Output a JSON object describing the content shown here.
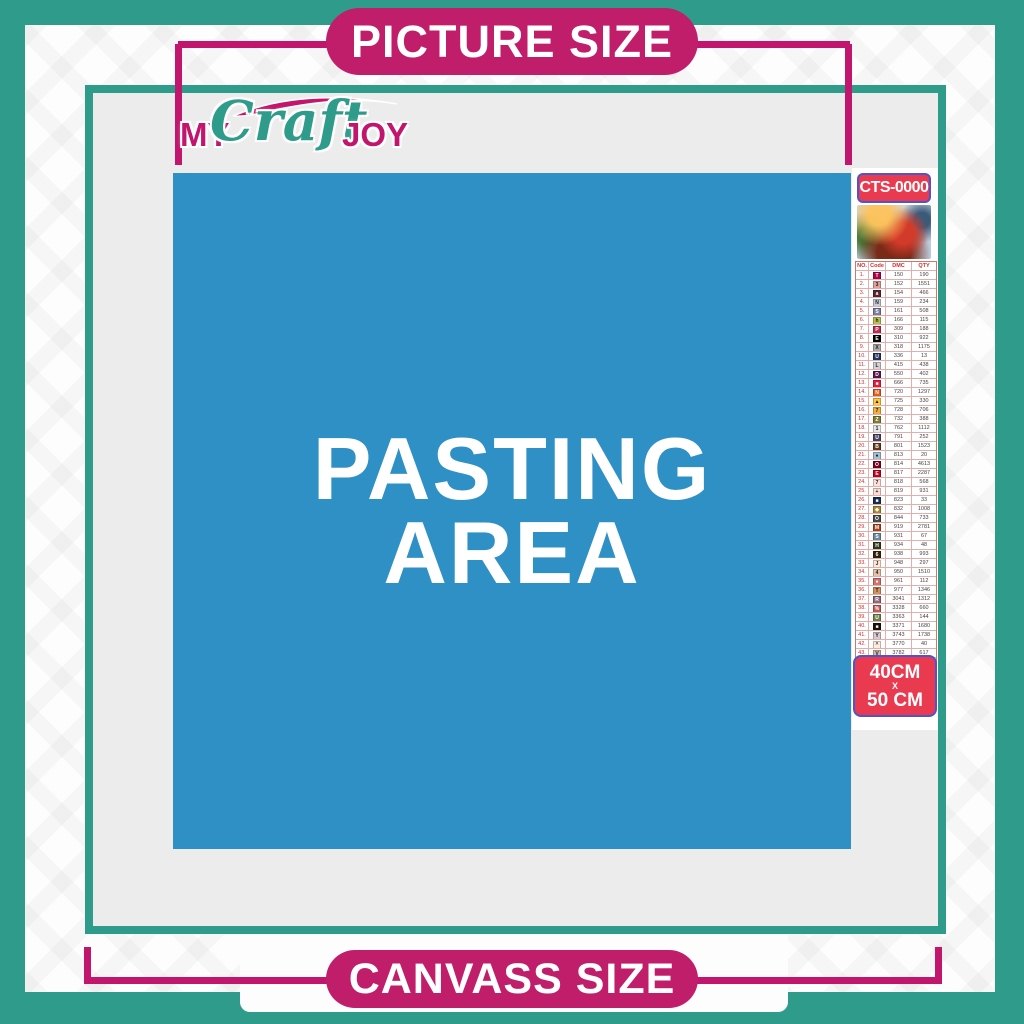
{
  "banners": {
    "top_label": "PICTURE SIZE",
    "bottom_label": "CANVASS SIZE"
  },
  "logo": {
    "word1": "MY",
    "word2": "Craft",
    "word3": "JOY"
  },
  "pasting_area": {
    "line1": "PASTING",
    "line2": "AREA"
  },
  "sidebar": {
    "code_badge": "CTS-0000",
    "thumbnail": "christmas-santa-sleigh-scene",
    "size_badge": {
      "line1": "40CM",
      "line2": "X",
      "line3": "50 CM"
    },
    "table": {
      "headers": [
        "NO.",
        "Code",
        "DMC",
        "QTY"
      ],
      "rows": [
        {
          "no": "1.",
          "sym": "T",
          "color": "#AB0249",
          "dmc": "150",
          "qty": "190"
        },
        {
          "no": "2.",
          "sym": "3",
          "color": "#E2A099",
          "dmc": "152",
          "qty": "1551"
        },
        {
          "no": "3.",
          "sym": "a",
          "color": "#572433",
          "dmc": "154",
          "qty": "466"
        },
        {
          "no": "4.",
          "sym": "N",
          "color": "#C7CAD7",
          "dmc": "159",
          "qty": "234"
        },
        {
          "no": "5.",
          "sym": "S",
          "color": "#7880A4",
          "dmc": "161",
          "qty": "508"
        },
        {
          "no": "6.",
          "sym": "h",
          "color": "#BDBE4F",
          "dmc": "166",
          "qty": "115"
        },
        {
          "no": "7.",
          "sym": "P",
          "color": "#BA2B55",
          "dmc": "309",
          "qty": "188"
        },
        {
          "no": "8.",
          "sym": "E",
          "color": "#000000",
          "dmc": "310",
          "qty": "922"
        },
        {
          "no": "9.",
          "sym": "X",
          "color": "#ABABAE",
          "dmc": "318",
          "qty": "1175"
        },
        {
          "no": "10.",
          "sym": "U",
          "color": "#25355F",
          "dmc": "336",
          "qty": "13"
        },
        {
          "no": "11.",
          "sym": "L",
          "color": "#D3D3D6",
          "dmc": "415",
          "qty": "438"
        },
        {
          "no": "12.",
          "sym": "D",
          "color": "#5C184E",
          "dmc": "550",
          "qty": "402"
        },
        {
          "no": "13.",
          "sym": "■",
          "color": "#E31D42",
          "dmc": "666",
          "qty": "735"
        },
        {
          "no": "14.",
          "sym": "N",
          "color": "#E55C1F",
          "dmc": "720",
          "qty": "1297"
        },
        {
          "no": "15.",
          "sym": "▲",
          "color": "#FFC840",
          "dmc": "725",
          "qty": "330"
        },
        {
          "no": "16.",
          "sym": "7",
          "color": "#F4AE3D",
          "dmc": "728",
          "qty": "706"
        },
        {
          "no": "17.",
          "sym": "Z",
          "color": "#7B7E36",
          "dmc": "732",
          "qty": "388"
        },
        {
          "no": "18.",
          "sym": "1",
          "color": "#E8E8E8",
          "dmc": "762",
          "qty": "1112"
        },
        {
          "no": "19.",
          "sym": "U",
          "color": "#464563",
          "dmc": "791",
          "qty": "252"
        },
        {
          "no": "20.",
          "sym": "B",
          "color": "#653919",
          "dmc": "801",
          "qty": "1523"
        },
        {
          "no": "21.",
          "sym": "●",
          "color": "#A1C2D7",
          "dmc": "813",
          "qty": "20"
        },
        {
          "no": "22.",
          "sym": "O",
          "color": "#7B001B",
          "dmc": "814",
          "qty": "4613"
        },
        {
          "no": "23.",
          "sym": "E",
          "color": "#BB051F",
          "dmc": "817",
          "qty": "2287"
        },
        {
          "no": "24.",
          "sym": "7",
          "color": "#FFDFD9",
          "dmc": "818",
          "qty": "568"
        },
        {
          "no": "25.",
          "sym": "+",
          "color": "#FBDDD4",
          "dmc": "819",
          "qty": "931"
        },
        {
          "no": "26.",
          "sym": "■",
          "color": "#1A2B51",
          "dmc": "823",
          "qty": "33"
        },
        {
          "no": "27.",
          "sym": "◆",
          "color": "#AC8734",
          "dmc": "832",
          "qty": "1008"
        },
        {
          "no": "28.",
          "sym": "O",
          "color": "#484848",
          "dmc": "844",
          "qty": "733"
        },
        {
          "no": "29.",
          "sym": "M",
          "color": "#A6451E",
          "dmc": "919",
          "qty": "2781"
        },
        {
          "no": "30.",
          "sym": "S",
          "color": "#6B8BA4",
          "dmc": "931",
          "qty": "67"
        },
        {
          "no": "31.",
          "sym": "H",
          "color": "#313919",
          "dmc": "934",
          "qty": "48"
        },
        {
          "no": "32.",
          "sym": "6",
          "color": "#36220C",
          "dmc": "938",
          "qty": "993"
        },
        {
          "no": "33.",
          "sym": "J",
          "color": "#FEE7DA",
          "dmc": "948",
          "qty": "297"
        },
        {
          "no": "34.",
          "sym": "4",
          "color": "#E9C1A8",
          "dmc": "950",
          "qty": "1510"
        },
        {
          "no": "35.",
          "sym": "●",
          "color": "#CF7373",
          "dmc": "961",
          "qty": "112"
        },
        {
          "no": "36.",
          "sym": "T",
          "color": "#D39259",
          "dmc": "977",
          "qty": "1346"
        },
        {
          "no": "37.",
          "sym": "R",
          "color": "#8A6A7D",
          "dmc": "3041",
          "qty": "1312"
        },
        {
          "no": "38.",
          "sym": "%",
          "color": "#C25B57",
          "dmc": "3328",
          "qty": "660"
        },
        {
          "no": "39.",
          "sym": "U",
          "color": "#6F8352",
          "dmc": "3363",
          "qty": "144"
        },
        {
          "no": "40.",
          "sym": "■",
          "color": "#1E1108",
          "dmc": "3371",
          "qty": "1680"
        },
        {
          "no": "41.",
          "sym": "Y",
          "color": "#D7CBD3",
          "dmc": "3743",
          "qty": "1738"
        },
        {
          "no": "42.",
          "sym": "^",
          "color": "#FFEADB",
          "dmc": "3770",
          "qty": "40"
        },
        {
          "no": "43.",
          "sym": "V",
          "color": "#D2BCA6",
          "dmc": "3782",
          "qty": "617"
        },
        {
          "no": "44.",
          "sym": "2",
          "color": "#CCC94F",
          "dmc": "3819",
          "qty": "119"
        },
        {
          "no": "45.",
          "sym": "✓",
          "color": "#FFFBD8",
          "dmc": "3823",
          "qty": "107"
        },
        {
          "no": "46.",
          "sym": "C",
          "color": "#E98A3E",
          "dmc": "3853",
          "qty": "1332"
        },
        {
          "no": "47.",
          "sym": "B",
          "color": "#8B4543",
          "dmc": "3858",
          "qty": "2311"
        },
        {
          "no": "48.",
          "sym": "A",
          "color": "#9B7458",
          "dmc": "3863",
          "qty": "1820"
        }
      ]
    }
  },
  "colors": {
    "teal": "#2F9C8B",
    "magenta": "#C2156D",
    "pill": "#C01E6B",
    "blue": "#2E90C5",
    "badgered": "#EA3A50",
    "badgeborder": "#4D55CE",
    "canvasgray": "#ECECEC"
  }
}
